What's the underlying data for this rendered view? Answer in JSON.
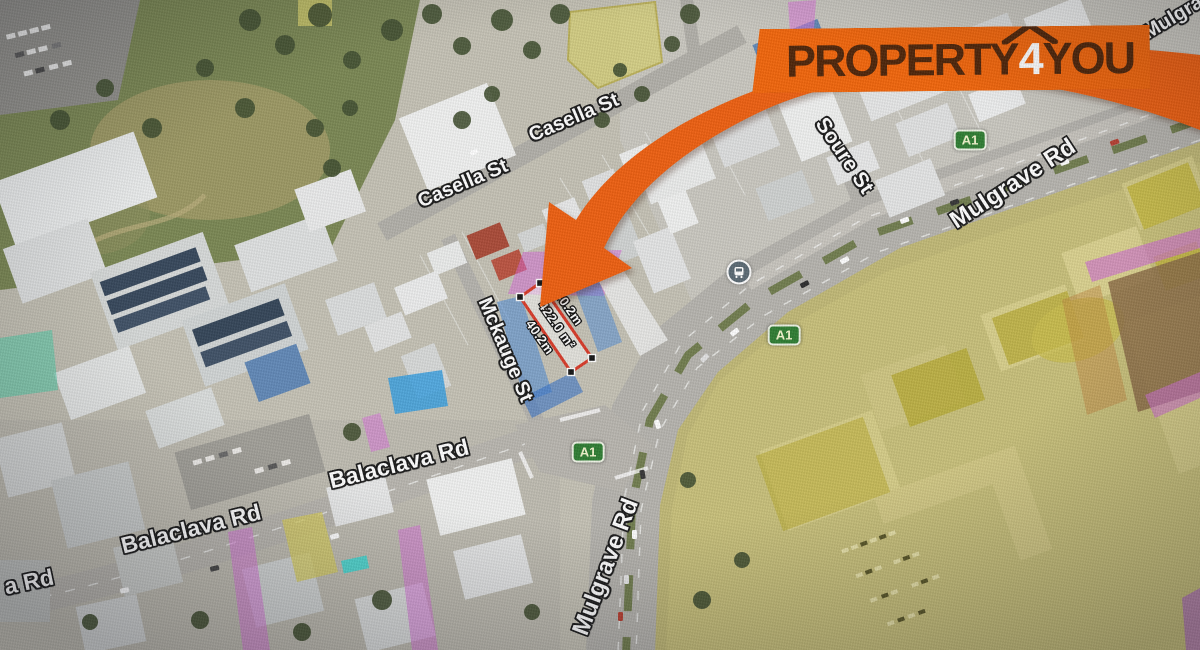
{
  "brand": {
    "logo_property": "PROPERTY",
    "logo_four": "4",
    "logo_you": "YOU",
    "banner_color": "#F2650A",
    "logo_text_color": "#4E2408",
    "arrow_color": "#EE5F10"
  },
  "parcel": {
    "outline_color": "#E5331F",
    "side_left": "40.2m",
    "area": "422.0 m²",
    "side_right": "40.2m"
  },
  "zone_colors": {
    "yellow": "#CDBD27",
    "pink": "#D965D9",
    "blue": "#3D7FD9",
    "teal": "#3FD1A8",
    "route_badge_green": "#2E7D32",
    "route_badge_text": "#F2F5CD"
  },
  "map_labels": [
    {
      "name": "street-label-casella-st-west",
      "text": "Casella St",
      "x": 463,
      "y": 184,
      "rot": -23,
      "size": 20,
      "cls": "street"
    },
    {
      "name": "street-label-casella-st-east",
      "text": "Casella St",
      "x": 574,
      "y": 118,
      "rot": -23,
      "size": 20,
      "cls": "street"
    },
    {
      "name": "street-label-soure-st",
      "text": "Soure St",
      "x": 844,
      "y": 156,
      "rot": 56,
      "size": 21,
      "cls": "street"
    },
    {
      "name": "street-label-mulgrave-rd-upper",
      "text": "Mulgrave Rd",
      "x": 1013,
      "y": 184,
      "rot": -33,
      "size": 24,
      "cls": "street"
    },
    {
      "name": "street-label-mulgrave-partial",
      "text": "Mulgrav",
      "x": 1178,
      "y": 15,
      "rot": -31,
      "size": 20,
      "cls": "street"
    },
    {
      "name": "street-label-mckauge-st",
      "text": "Mckauge St",
      "x": 505,
      "y": 350,
      "rot": 67,
      "size": 20,
      "cls": "street"
    },
    {
      "name": "street-label-balaclava-rd-west",
      "text": "Balaclava Rd",
      "x": 191,
      "y": 529,
      "rot": -14,
      "size": 23,
      "cls": "street"
    },
    {
      "name": "street-label-balaclava-rd-east",
      "text": "Balaclava Rd",
      "x": 399,
      "y": 464,
      "rot": -14,
      "size": 23,
      "cls": "street"
    },
    {
      "name": "street-label-balaclava-partial",
      "text": "a Rd",
      "x": 29,
      "y": 582,
      "rot": -12,
      "size": 23,
      "cls": "street"
    },
    {
      "name": "street-label-mulgrave-rd-lower",
      "text": "Mulgrave Rd",
      "x": 606,
      "y": 567,
      "rot": -69,
      "size": 24,
      "cls": "street"
    },
    {
      "name": "measurement-side-left",
      "text": "40.2m",
      "x": 540,
      "y": 337,
      "rot": 55,
      "size": 13,
      "cls": "measure"
    },
    {
      "name": "measurement-area",
      "text": "422.0 m²",
      "x": 557,
      "y": 325,
      "rot": 55,
      "size": 13,
      "cls": "measure"
    },
    {
      "name": "measurement-side-right",
      "text": "40.2m",
      "x": 569,
      "y": 308,
      "rot": 55,
      "size": 13,
      "cls": "measure"
    }
  ],
  "route_badges": [
    {
      "name": "route-badge-a1-north",
      "label": "A1",
      "x": 970,
      "y": 140
    },
    {
      "name": "route-badge-a1-mid",
      "label": "A1",
      "x": 784,
      "y": 335
    },
    {
      "name": "route-badge-a1-south",
      "label": "A1",
      "x": 588,
      "y": 452
    }
  ],
  "bus_stop": {
    "name": "bus-stop-icon",
    "icon": "bus-icon",
    "x": 739,
    "y": 272
  }
}
